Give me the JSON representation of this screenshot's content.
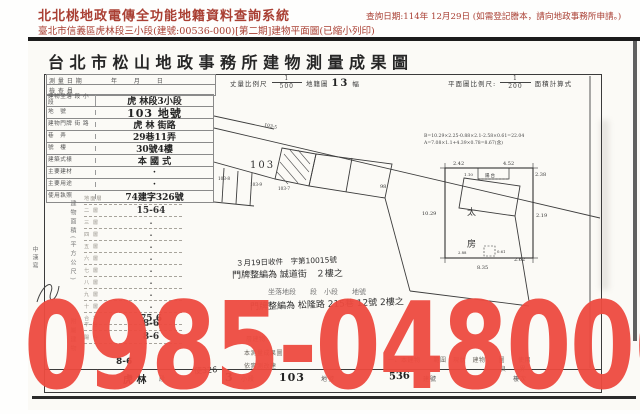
{
  "header": {
    "system_title": "北北桃地政電傳全功能地籍資料查詢系統",
    "query_date": "查詢日期:114年 12月29日 (如需登記謄本，請向地政事務所申請。)",
    "subtitle": "臺北市信義區虎林段三小段(建號:00536-000)[第二期]建物平面圖(已縮小列印)"
  },
  "doc": {
    "title": "台北市松山地政事務所建物測量成果圖",
    "form_header": {
      "survey_date_label": "測 量 日 期",
      "survey_date_value": "年　 月　 日",
      "inspector_label": "檢 查 員",
      "scale_prefix": "丈量",
      "scale_label": "比例尺",
      "scale_num": "1",
      "scale_den": "500",
      "sheet_label": "地籍圖",
      "sheet_no": "13",
      "sheet_unit": "幅",
      "plan_scale_label": "平面圖比例尺:",
      "plan_scale_num": "1",
      "plan_scale_den": "200",
      "area_calc_label": "面積計算式"
    },
    "table": {
      "rows": [
        {
          "label": "建物坐落 段 小段",
          "value": "虎 林段3小段"
        },
        {
          "label": "地　號",
          "value": "103  地號"
        },
        {
          "label": "建物門牌 街 路",
          "value": "虎 林 街路"
        },
        {
          "label": "巷　弄",
          "value": "29巷11弄"
        },
        {
          "label": "號　樓",
          "value": "30號4樓"
        },
        {
          "label": "建築式樣",
          "value": "本 國 式"
        },
        {
          "label": "主要建材",
          "value": "·"
        },
        {
          "label": "主要用途",
          "value": "·"
        },
        {
          "label": "使用執照",
          "value": "74建字326號"
        }
      ]
    },
    "area": {
      "section_label": "建物面積(平方公尺)",
      "rows": [
        {
          "label": "地面層",
          "value": "·"
        },
        {
          "label": "二 層",
          "value": "15-64"
        },
        {
          "label": "三 層",
          "value": "·"
        },
        {
          "label": "四 層",
          "value": "·"
        },
        {
          "label": "五 層",
          "value": "·"
        },
        {
          "label": "六 層",
          "value": "·"
        },
        {
          "label": "七 層",
          "value": "·"
        },
        {
          "label": "八 層",
          "value": "·"
        },
        {
          "label": "九 層",
          "value": "·"
        },
        {
          "label": "十 層",
          "value": "·"
        },
        {
          "label": "合 計",
          "value": "75.6"
        }
      ]
    },
    "annex": {
      "section_label": "附屬建物",
      "rows": [
        {
          "label": "平 台",
          "value": "8-6"
        },
        {
          "label": "陽 台",
          "value": "8-6"
        }
      ]
    },
    "footer": {
      "value_left": "8-6",
      "permit_note": "使326",
      "seg_value": "虎  林",
      "seg_label": "段",
      "minor_value": "3",
      "minor_label": "小段",
      "parcel_value": "103",
      "parcel_label": "地號",
      "building_value": "536",
      "building_label": "建號",
      "floor_label": "樓次"
    },
    "notes": {
      "frag1": "層建物",
      "frag2": "本測量成果圖",
      "frag3": "依實測改建",
      "line1": "一、本建物　　範圍　現狀　建物　　圖　　使用",
      "line2": "良　　界"
    },
    "handnotes": {
      "n1a": "３月19日收件　字第10015號",
      "n1b": "門牌整編為 誠道街　２樓之",
      "n2a": "坐落地段　　段　小段　　地號",
      "n2b": "門牌整編為 松隆路 215巷 12號 2樓之",
      "margin": "中漢寫"
    },
    "map": {
      "parcel_main": "103",
      "p1": "103-5",
      "p2": "103-8",
      "p3": "103-9",
      "p4": "103-7",
      "p5": "98"
    },
    "plan": {
      "formula1": "B=10.29×2.25-0.88×2.1-2.58×0.61=22.04",
      "formula2": "A=7.08×1.1+4.39×0.78=8.67(含)",
      "dim_top1": "2.42",
      "dim_top2": "4.52",
      "dim_right_top": "2.38",
      "dim_right": "2.19",
      "dim_left": "10.29",
      "dim_bottom": "8.35",
      "dim_bottom2": "2.62",
      "dim_small1": "2.88",
      "dim_small2": "0.61",
      "balcony_label": "陽台",
      "balcony_dim": "1.10",
      "inner1": "太",
      "inner2": "房"
    }
  },
  "watermark": {
    "text": "0985-048006",
    "color": "#ee4b40"
  }
}
